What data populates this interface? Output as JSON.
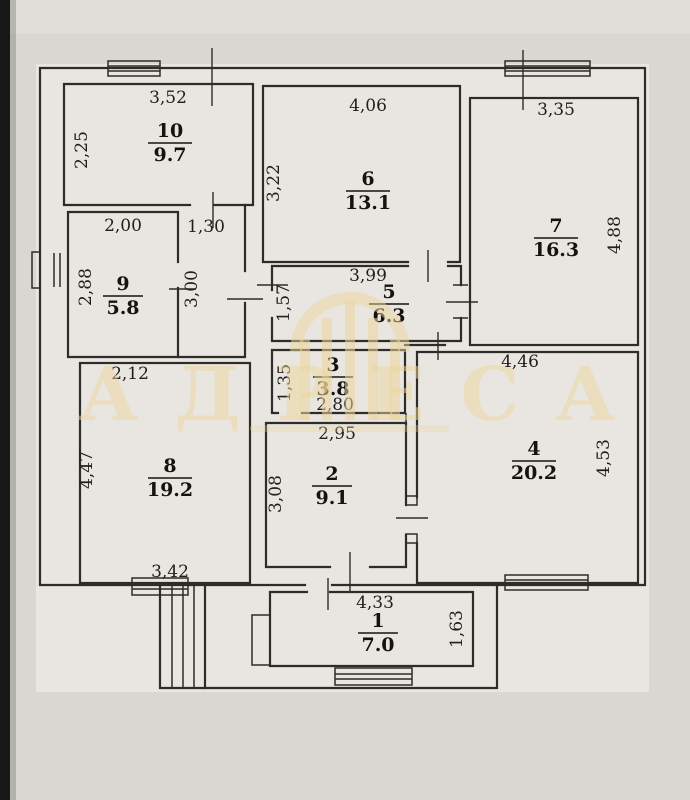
{
  "watermark": {
    "text": "АДРЕСА"
  },
  "corridor": {
    "dim_width": "1,30",
    "dim_length": "3,00"
  },
  "rooms": [
    {
      "number": "1",
      "area": "7.0",
      "dim_top": "4,33",
      "dim_right": "1,63"
    },
    {
      "number": "2",
      "area": "9.1",
      "dim_top": "2,95",
      "dim_left": "3,08"
    },
    {
      "number": "3",
      "area": "3.8",
      "dim_left": "1,35",
      "dim_bottom": "2,80"
    },
    {
      "number": "4",
      "area": "20.2",
      "dim_top": "4,46",
      "dim_right": "4,53"
    },
    {
      "number": "5",
      "area": "6.3",
      "dim_top": "3,99",
      "dim_left": "1,57"
    },
    {
      "number": "6",
      "area": "13.1",
      "dim_top": "4,06",
      "dim_left": "3,22"
    },
    {
      "number": "7",
      "area": "16.3",
      "dim_top": "3,35",
      "dim_right": "4,88"
    },
    {
      "number": "8",
      "area": "19.2",
      "dim_top": "2,12",
      "dim_left": "4,47",
      "dim_bottom": "3,42"
    },
    {
      "number": "9",
      "area": "5.8",
      "dim_top": "2,00",
      "dim_left": "2,88"
    },
    {
      "number": "10",
      "area": "9.7",
      "dim_top": "3,52",
      "dim_left": "2,25"
    }
  ],
  "colors": {
    "paper": "#e9e6e1",
    "photo_background": "#d9d7d2",
    "line": "#2e2c29",
    "watermark": "#ecd69c",
    "photo_edge": "#171717"
  }
}
